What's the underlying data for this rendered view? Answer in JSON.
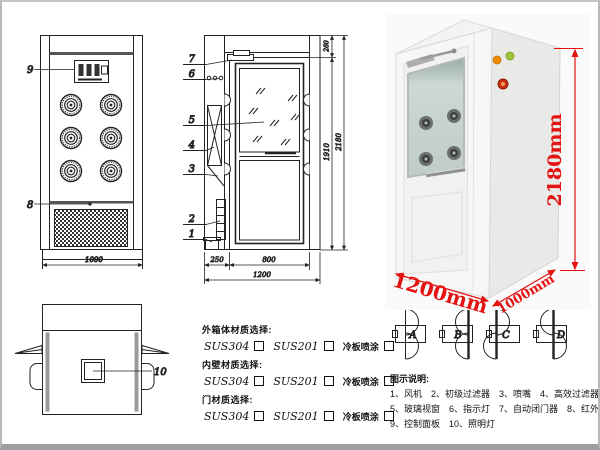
{
  "colors": {
    "dimension_red": "#e51212",
    "drawing_line": "#222222",
    "indicator_orange": "#f08a00",
    "indicator_green": "#9ec43a",
    "emergency_button_red": "#cc2e10"
  },
  "front_view": {
    "callout_9": "9",
    "callout_8": "8",
    "dim_width": "1000"
  },
  "side_view": {
    "callout_7": "7",
    "callout_6": "6",
    "callout_5": "5",
    "callout_4": "4",
    "callout_3": "3",
    "callout_2": "2",
    "callout_1": "1",
    "dim_top": "260",
    "dim_door_height": "1910",
    "dim_total_height": "2180",
    "dim_side": "250",
    "dim_door_width": "800",
    "dim_total_width": "1200"
  },
  "top_view": {
    "callout_10": "10"
  },
  "materials": {
    "outer_label": "外箱体材质选择:",
    "inner_label": "内壁材质选择:",
    "door_label": "门材质选择:",
    "option_1": "SUS304",
    "option_2": "SUS201",
    "option_3": "冷板喷涂"
  },
  "photo": {
    "dim_height": "2180mm",
    "dim_width": "1200mm",
    "dim_depth": "1000mm"
  },
  "door_options": {
    "option_a": "A",
    "option_b": "B",
    "option_c": "C",
    "option_d": "D"
  },
  "legend": {
    "title": "图示说明:",
    "line_1": "1、风机　2、初级过滤器　3、喷嘴　4、高效过滤器",
    "line_2": "5、玻璃视窗　6、指示灯　7、自动闭门器　8、红外线感应器",
    "line_3": "9、控制面板　10、照明灯"
  }
}
